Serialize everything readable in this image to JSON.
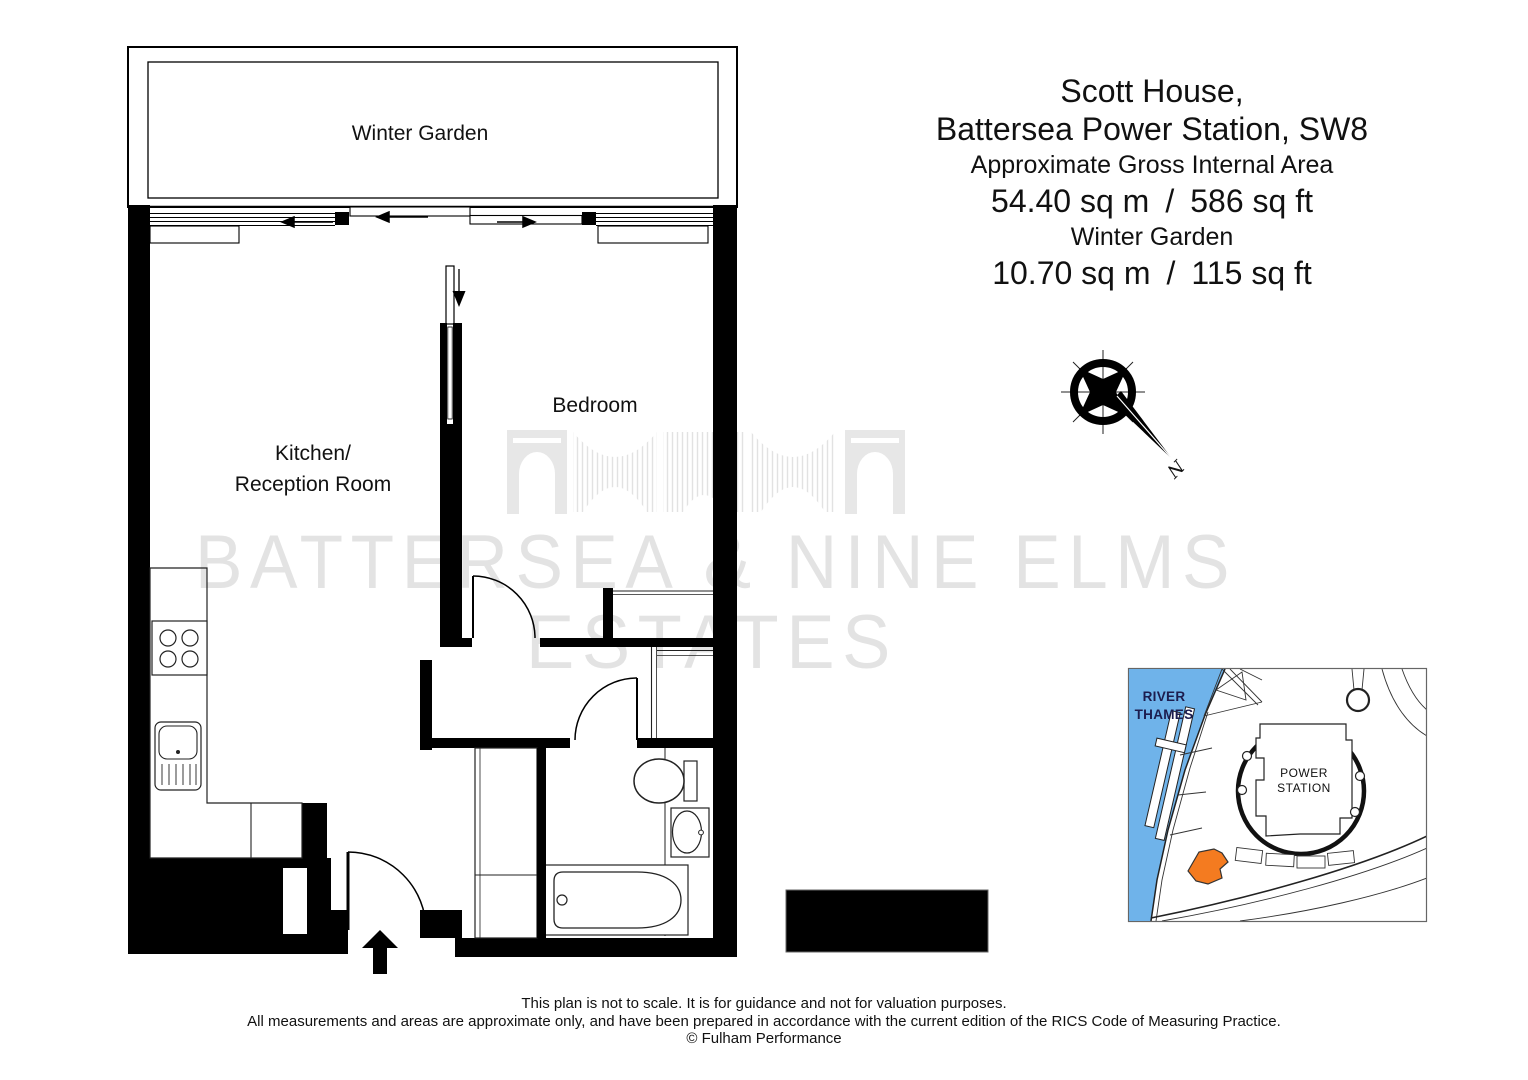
{
  "title_block": {
    "line1": "Scott House,",
    "line2": "Battersea Power Station, SW8",
    "area_label": "Approximate Gross Internal Area",
    "area_value": "54.40 sq m / 586 sq ft",
    "garden_label": "Winter Garden",
    "garden_value": "10.70 sq m / 115 sq ft"
  },
  "rooms": {
    "winter_garden": "Winter Garden",
    "bedroom": "Bedroom",
    "kitchen_line1": "Kitchen/",
    "kitchen_line2": "Reception Room"
  },
  "compass": {
    "north_label": "N"
  },
  "watermark": {
    "line1": "BATTERSEA & NINE ELMS",
    "line2": "ESTATES",
    "color": "#e3e3e3"
  },
  "map": {
    "river_label_line1": "RIVER",
    "river_label_line2": "THAMES",
    "station_label_line1": "POWER",
    "station_label_line2": "STATION",
    "river_color": "#6fb3ea",
    "highlight_color": "#f47b20"
  },
  "footer": {
    "line1": "This plan is not to scale. It is for guidance and not for valuation purposes.",
    "line2": "All measurements and areas are approximate only, and have been prepared in accordance with the current edition of the RICS Code of Measuring Practice.",
    "line3": "© Fulham Performance"
  }
}
